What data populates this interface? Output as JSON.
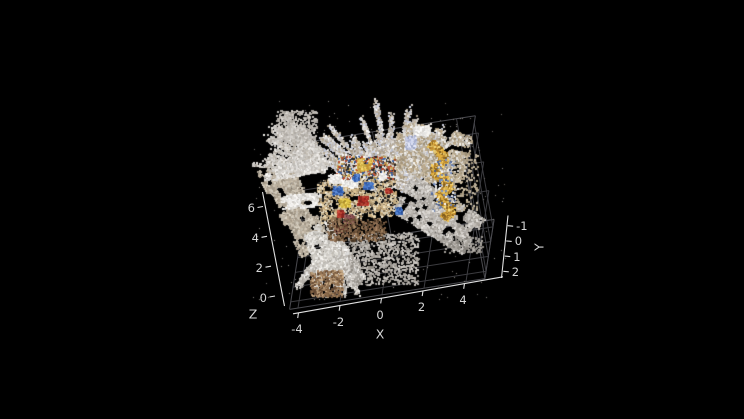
{
  "figure": {
    "kind": "3d-point-cloud-viewer",
    "background": "#000000",
    "style": {
      "ruler_color": "#e0e0e0",
      "grid_color": "#3c3c40",
      "edge_color": "#4b4b50",
      "tick_label_color": "#d6d6d6"
    }
  },
  "chart_data": {
    "type": "scatter",
    "projection": "3d",
    "title": "",
    "description": "Colored 3D point cloud of an indoor desk scene shown on a black background (MATLAB pcshow style), viewed from a high oblique angle. Pale gray scan sheets of walls/floor radiate in fans from a small, densely colored desk cluster (tan tabletop with blue, red, yellow, white and dark-brown objects). A gold zig-zag curtain-like ribbon stands at the right, and a spray of points with brown floor speckles fans toward the lower left. Dark gray grid planes (floor and two far walls) frame the cloud.",
    "axes": {
      "x": {
        "label": "X",
        "ticks": [
          -4,
          -2,
          0,
          2,
          4
        ],
        "tick_labels": [
          "-4",
          "-2",
          "0",
          "2",
          "4"
        ],
        "range": [
          -4.4,
          4.9
        ]
      },
      "y": {
        "label": "Y",
        "ticks": [
          -1,
          0,
          1,
          2
        ],
        "tick_labels": [
          "-1",
          "0",
          "1",
          "2"
        ],
        "range": [
          -1.5,
          2.5
        ]
      },
      "z": {
        "label": "Z",
        "ticks": [
          0,
          2,
          4,
          6
        ],
        "tick_labels": [
          "0",
          "2",
          "4",
          "6"
        ],
        "range": [
          0,
          7.2
        ]
      }
    },
    "grid": true,
    "legend": null,
    "point_cloud": {
      "approx_point_size_px": 2,
      "clusters": [
        {
          "name": "left-band",
          "type": "sheet",
          "center": [
            293,
            206
          ],
          "len": 96,
          "wid": 34,
          "rot": 62,
          "holes": 0.25,
          "count": 5200,
          "size": 2,
          "palette": [
            "#b3a897",
            "#c2b8a8",
            "#a69b8a",
            "#cfc8ba"
          ]
        },
        {
          "name": "top-fan",
          "type": "fan",
          "apex": [
            391,
            198
          ],
          "angle": [
            -155,
            -35
          ],
          "r": [
            12,
            92
          ],
          "streaks": 42,
          "count": 13000,
          "size": 2,
          "palette": [
            "#d7d3cf",
            "#c8c2bb",
            "#b9b0a4",
            "#eeedeb",
            "#c6cad9",
            "#b0a491"
          ]
        },
        {
          "name": "left-wisp-fan",
          "type": "fan",
          "apex": [
            332,
            172
          ],
          "angle": [
            -178,
            -120
          ],
          "r": [
            8,
            78
          ],
          "streaks": 22,
          "count": 3000,
          "size": 2,
          "palette": [
            "#cfccc7",
            "#dedbd7",
            "#bdb7ae"
          ]
        },
        {
          "name": "left-white-wisp",
          "type": "sheet",
          "center": [
            293,
            169
          ],
          "len": 60,
          "wid": 13,
          "rot": -10,
          "holes": 0.3,
          "count": 1500,
          "size": 2,
          "palette": [
            "#dcd9d5",
            "#ebe9e6",
            "#c9c5bf"
          ]
        },
        {
          "name": "left-white-patch",
          "type": "sheet",
          "center": [
            301,
            200
          ],
          "len": 40,
          "wid": 13,
          "rot": -6,
          "holes": 0.25,
          "count": 1300,
          "size": 2,
          "palette": [
            "#e9e7e4",
            "#f3f2f0",
            "#d5d2cc"
          ]
        },
        {
          "name": "top-left-speckle",
          "type": "speckle",
          "rect": [
            276,
            110,
            40,
            32
          ],
          "count": 420,
          "size": 2,
          "palette": [
            "#cac6c1",
            "#b5b0a9"
          ]
        },
        {
          "name": "right-clump",
          "type": "sheet",
          "center": [
            430,
            155
          ],
          "len": 74,
          "wid": 56,
          "rot": 12,
          "holes": 0.3,
          "count": 7000,
          "size": 2,
          "palette": [
            "#c2b59e",
            "#cbc7c1",
            "#b7a588",
            "#e6e4e0",
            "#a89a80"
          ]
        },
        {
          "name": "white-patch-top-right",
          "type": "sheet",
          "center": [
            421,
            130
          ],
          "len": 16,
          "wid": 9,
          "rot": 0,
          "holes": 0.1,
          "count": 400,
          "size": 2,
          "palette": [
            "#f1f0ee",
            "#e2e0dc"
          ]
        },
        {
          "name": "blue-patch-top-right",
          "type": "sheet",
          "center": [
            410,
            142
          ],
          "len": 10,
          "wid": 13,
          "rot": 0,
          "holes": 0.15,
          "count": 400,
          "size": 2,
          "palette": [
            "#c2c7df",
            "#a9b2d2",
            "#d4d8e8"
          ]
        },
        {
          "name": "right-sheet",
          "type": "sheet",
          "center": [
            437,
            214
          ],
          "len": 84,
          "wid": 42,
          "rot": 31,
          "holes": 0.32,
          "count": 7500,
          "size": 2,
          "palette": [
            "#c6c2bd",
            "#b7b2ac",
            "#d6d3cf",
            "#a5a099"
          ]
        },
        {
          "name": "bottom-fan",
          "type": "fan",
          "apex": [
            334,
            230
          ],
          "angle": [
            55,
            126
          ],
          "r": [
            10,
            66
          ],
          "streaks": 26,
          "count": 5200,
          "size": 2,
          "palette": [
            "#dbd8d3",
            "#c5c1bb",
            "#afaaa3",
            "#edecea"
          ]
        },
        {
          "name": "bottom-core",
          "type": "sheet",
          "center": [
            323,
            247
          ],
          "len": 48,
          "wid": 30,
          "rot": 72,
          "holes": 0.2,
          "count": 2600,
          "size": 2,
          "palette": [
            "#e7e5e1",
            "#d3d0ca",
            "#c0bcb5"
          ]
        },
        {
          "name": "bottom-brown-tip",
          "type": "speckle",
          "rect": [
            310,
            270,
            32,
            26
          ],
          "count": 420,
          "size": 2,
          "palette": [
            "#8a6a4a",
            "#a08060",
            "#6b4f38",
            "#bfa27f"
          ]
        },
        {
          "name": "bottom-spray-right",
          "type": "speckle",
          "rect": [
            348,
            232,
            70,
            52
          ],
          "count": 900,
          "size": 2,
          "palette": [
            "#b5b1ab",
            "#9b968f",
            "#c8c4bf"
          ]
        },
        {
          "name": "desk-base",
          "type": "sheet",
          "center": [
            357,
            197
          ],
          "len": 78,
          "wid": 42,
          "rot": -6,
          "holes": 0.22,
          "count": 5200,
          "size": 2,
          "palette": [
            "#cdb58b",
            "#dcc9a4",
            "#e6dec9",
            "#bfa477",
            "#8f7a5c",
            "#1c1c1c"
          ]
        },
        {
          "name": "desk-shelf",
          "type": "speckle",
          "rect": [
            336,
            156,
            58,
            22
          ],
          "count": 1000,
          "size": 2,
          "palette": [
            "#dcd8d1",
            "#3a5f9e",
            "#242424",
            "#b24a2e",
            "#c8a858",
            "#efede7",
            "#8a6a50"
          ]
        },
        {
          "name": "desk-top-yellow-object",
          "type": "sheet",
          "center": [
            364,
            164
          ],
          "len": 14,
          "wid": 12,
          "rot": 0,
          "holes": 0.15,
          "count": 350,
          "size": 2,
          "palette": [
            "#d8b84a",
            "#c89838",
            "#e6cc6a"
          ]
        },
        {
          "name": "white-paper-0",
          "type": "sheet",
          "center": [
            334,
            178
          ],
          "len": 12,
          "wid": 8,
          "rot": 0,
          "holes": 0.1,
          "count": 220,
          "size": 2,
          "palette": [
            "#ebe9e5",
            "#f4f3f1"
          ]
        },
        {
          "name": "white-paper-1",
          "type": "sheet",
          "center": [
            349,
            183
          ],
          "len": 15,
          "wid": 8,
          "rot": -5,
          "holes": 0.1,
          "count": 300,
          "size": 2,
          "palette": [
            "#ebe9e5",
            "#f4f3f1"
          ]
        },
        {
          "name": "white-paper-2",
          "type": "sheet",
          "center": [
            379,
            176
          ],
          "len": 12,
          "wid": 7,
          "rot": -5,
          "holes": 0.1,
          "count": 240,
          "size": 2,
          "palette": [
            "#ebe9e5",
            "#f4f3f1"
          ]
        },
        {
          "name": "blue-object-1",
          "type": "sheet",
          "center": [
            337,
            190
          ],
          "len": 9,
          "wid": 7,
          "rot": 0,
          "holes": 0,
          "count": 260,
          "size": 2,
          "palette": [
            "#3f6fbe",
            "#5b86cf",
            "#2d54a0"
          ]
        },
        {
          "name": "blue-object-2",
          "type": "sheet",
          "center": [
            368,
            185
          ],
          "len": 9,
          "wid": 6,
          "rot": 0,
          "holes": 0,
          "count": 240,
          "size": 2,
          "palette": [
            "#3f6fbe",
            "#5b86cf",
            "#2d54a0"
          ]
        },
        {
          "name": "blue-object-3",
          "type": "sheet",
          "center": [
            355,
            177
          ],
          "len": 6,
          "wid": 5,
          "rot": 0,
          "holes": 0,
          "count": 140,
          "size": 2,
          "palette": [
            "#3f6fbe",
            "#5b86cf",
            "#2d54a0"
          ]
        },
        {
          "name": "blue-object-4",
          "type": "sheet",
          "center": [
            398,
            210
          ],
          "len": 6,
          "wid": 6,
          "rot": 0,
          "holes": 0,
          "count": 140,
          "size": 2,
          "palette": [
            "#3f6fbe",
            "#5b86cf",
            "#2d54a0"
          ]
        },
        {
          "name": "red-object-1",
          "type": "sheet",
          "center": [
            362,
            200
          ],
          "len": 9,
          "wid": 8,
          "rot": 0,
          "holes": 0,
          "count": 260,
          "size": 2,
          "palette": [
            "#ab2d26",
            "#c24a3a",
            "#8c241e"
          ]
        },
        {
          "name": "red-object-2",
          "type": "sheet",
          "center": [
            340,
            213
          ],
          "len": 6,
          "wid": 6,
          "rot": 0,
          "holes": 0,
          "count": 150,
          "size": 2,
          "palette": [
            "#ab2d26",
            "#c24a3a",
            "#8c241e"
          ]
        },
        {
          "name": "red-object-3",
          "type": "sheet",
          "center": [
            388,
            190
          ],
          "len": 5,
          "wid": 4,
          "rot": 0,
          "holes": 0,
          "count": 90,
          "size": 2,
          "palette": [
            "#ab2d26",
            "#c24a3a",
            "#8c241e"
          ]
        },
        {
          "name": "yellow-object",
          "type": "sheet",
          "center": [
            344,
            202
          ],
          "len": 10,
          "wid": 8,
          "rot": 0,
          "holes": 0,
          "count": 260,
          "size": 2,
          "palette": [
            "#d6bc45",
            "#e8d060",
            "#b89a32"
          ]
        },
        {
          "name": "maroon-object",
          "type": "sheet",
          "center": [
            348,
            218
          ],
          "len": 9,
          "wid": 8,
          "rot": 0,
          "holes": 0,
          "count": 240,
          "size": 2,
          "palette": [
            "#7a4747",
            "#935a5a",
            "#5e3434"
          ]
        },
        {
          "name": "maroon-spot-2",
          "type": "sheet",
          "center": [
            340,
            228
          ],
          "len": 12,
          "wid": 7,
          "rot": 0,
          "holes": 0,
          "count": 160,
          "size": 2,
          "palette": [
            "#6e3c34",
            "#50281f"
          ]
        },
        {
          "name": "desk-bottom-browns",
          "type": "speckle",
          "rect": [
            327,
            218,
            58,
            22
          ],
          "count": 450,
          "size": 2,
          "palette": [
            "#6b5138",
            "#8a6a50",
            "#4a3826",
            "#9c7d5d"
          ]
        },
        {
          "name": "gold-zigzag-curtain",
          "type": "ribbon",
          "points": [
            [
              430,
              142
            ],
            [
              445,
              157
            ],
            [
              432,
              170
            ],
            [
              450,
              184
            ],
            [
              437,
              197
            ],
            [
              452,
              209
            ],
            [
              443,
              218
            ]
          ],
          "width": 8,
          "count": 1600,
          "size": 2,
          "palette": [
            "#d9a93d",
            "#e5bd55",
            "#b3812c",
            "#8a6420",
            "#efd27a"
          ]
        },
        {
          "name": "zigzag-deco-specks",
          "type": "speckle",
          "rect": [
            431,
            158,
            24,
            52
          ],
          "count": 90,
          "size": 2,
          "palette": [
            "#4a5f8e",
            "#e8e8e8",
            "#7289b8"
          ]
        },
        {
          "name": "right-of-curtain-specks",
          "type": "speckle",
          "rect": [
            452,
            150,
            26,
            60
          ],
          "count": 160,
          "size": 2,
          "palette": [
            "#c2b59e",
            "#a89a80"
          ]
        },
        {
          "name": "right-trail",
          "type": "speckle",
          "rect": [
            442,
            236,
            40,
            16
          ],
          "count": 140,
          "size": 2,
          "palette": [
            "#a5a19b",
            "#8b8781"
          ]
        },
        {
          "name": "stray-outliers",
          "type": "speckle",
          "rect": [
            252,
            100,
            256,
            200
          ],
          "count": 220,
          "size": 1,
          "palette": [
            "#8f8b86",
            "#726e69"
          ]
        }
      ]
    }
  }
}
